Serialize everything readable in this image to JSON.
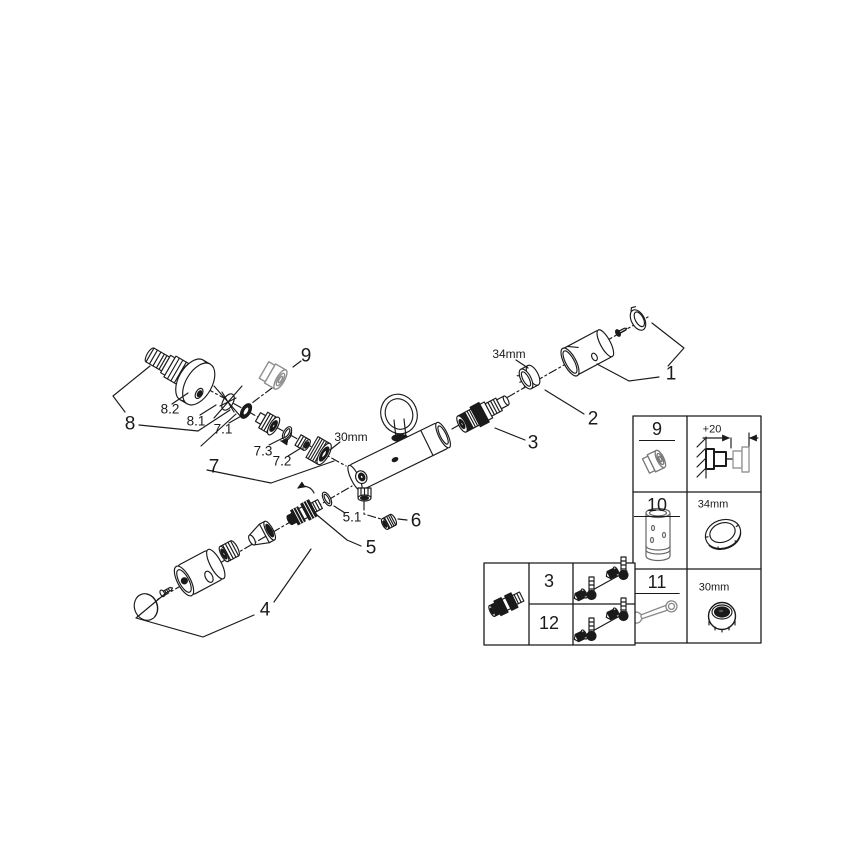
{
  "figure": {
    "type": "exploded-parts-diagram",
    "description": "Thermostatic shower mixer exploded spare-parts drawing",
    "colors": {
      "line": "#1a1a1a",
      "gray_part": "#8f8f8f",
      "background": "#ffffff"
    }
  },
  "labels": {
    "p1": "1",
    "p2": "2",
    "p3": "3",
    "p4": "4",
    "p5": "5",
    "p5_1": "5.1",
    "p6": "6",
    "p7": "7",
    "p7_1": "7.1",
    "p7_2": "7.2",
    "p7_3": "7.3",
    "p8": "8",
    "p8_1": "8.1",
    "p8_2": "8.2",
    "p9": "9"
  },
  "dimensions": {
    "ring_34": "34mm",
    "nut_30": "30mm"
  },
  "legend_right": {
    "rows": [
      {
        "num": "9",
        "icon": "cap-icon",
        "detail_dim": "+20",
        "detail_icon": "wall-installation-depth-diagram"
      },
      {
        "num": "10",
        "icon": "extension-sleeve-icon",
        "detail_dim": "34mm",
        "detail_icon": "ring-nut-34mm-icon"
      },
      {
        "num": "11",
        "icon": "wrench-icon",
        "detail_dim": "30mm",
        "detail_icon": "cap-nut-30mm-icon"
      }
    ]
  },
  "legend_bottom": {
    "item_icon": "thermostat-cartridge-icon",
    "rows": [
      {
        "num": "3",
        "icon": "check-valves-and-thermometers-icon"
      },
      {
        "num": "12",
        "icon": "check-valves-and-thermometers-icon"
      }
    ]
  }
}
